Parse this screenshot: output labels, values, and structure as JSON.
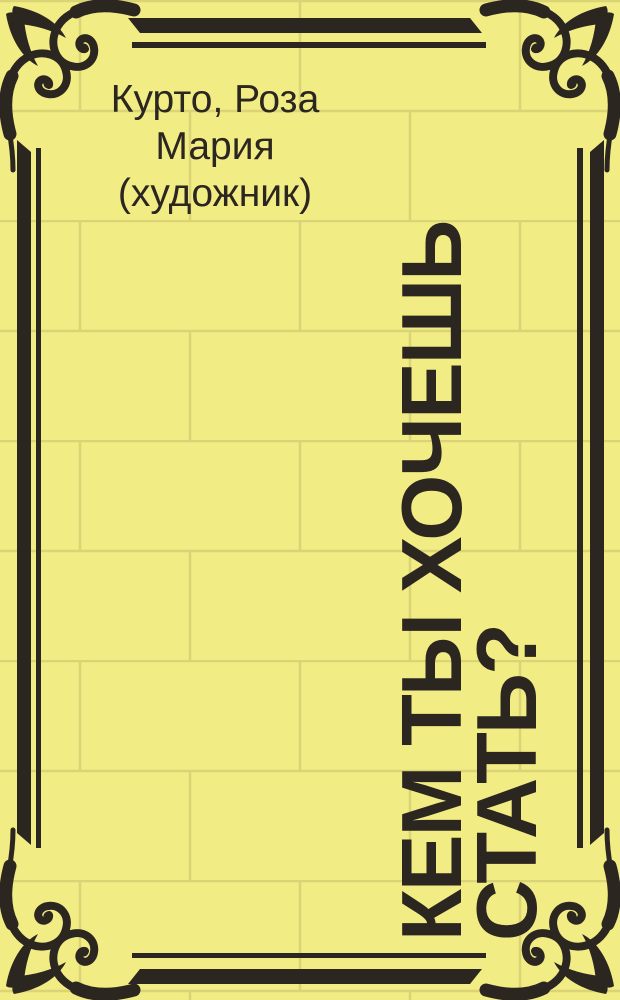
{
  "author": {
    "full": "Курто, Роза Мария (художник)",
    "lines": [
      "Курто, Роза",
      "Мария",
      "(художник)"
    ]
  },
  "title": {
    "full": "КЕМ ТЫ ХОЧЕШЬ СТАТЬ?",
    "lines": [
      "КЕМ ТЫ ХОЧЕШЬ",
      "СТАТЬ?"
    ],
    "rotation_deg": -90
  },
  "colors": {
    "background": "#f2ec84",
    "brick_line": "#dbd476",
    "ink": "#2b2620"
  },
  "decorations": {
    "background_pattern": "brick-wall-pattern",
    "frame_style": "double-rule-ornamental-frame",
    "corner_ornament": "scroll-fleuron"
  }
}
